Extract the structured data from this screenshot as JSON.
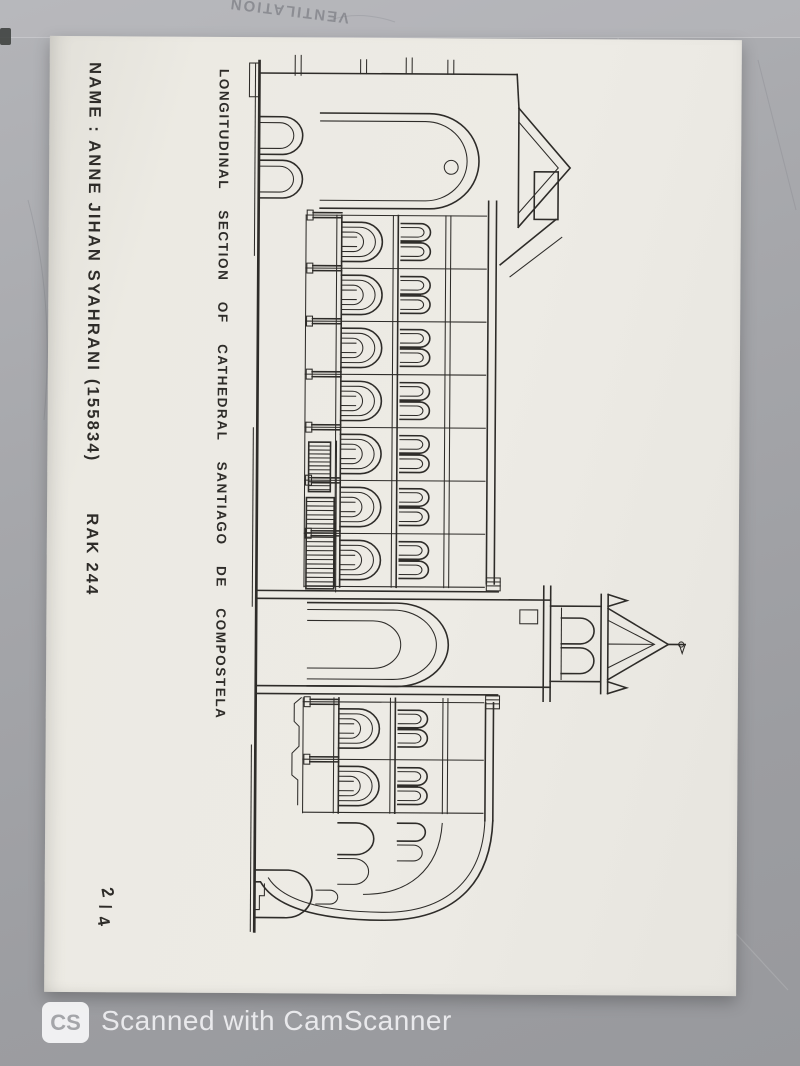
{
  "background": {
    "faint_text": "VENTILATION"
  },
  "sheet": {
    "name_label": "NAME : ANNE JIHAN SYAHRANI (155834)",
    "course_code": "RAK 244",
    "title": "LONGITUDINAL SECTION OF CATHEDRAL SANTIAGO DE COMPOSTELA",
    "page_number": {
      "numerator": "2",
      "separator": "/",
      "denominator": "4"
    }
  },
  "watermark": {
    "logo": "CS",
    "text": "Scanned with CamScanner"
  },
  "colors": {
    "background_gray": "#a6a7ab",
    "paper": "#ebe9e3",
    "ink": "#2e2c29",
    "pencil_note": "#6b6d72",
    "watermark_text": "#fafafc"
  }
}
